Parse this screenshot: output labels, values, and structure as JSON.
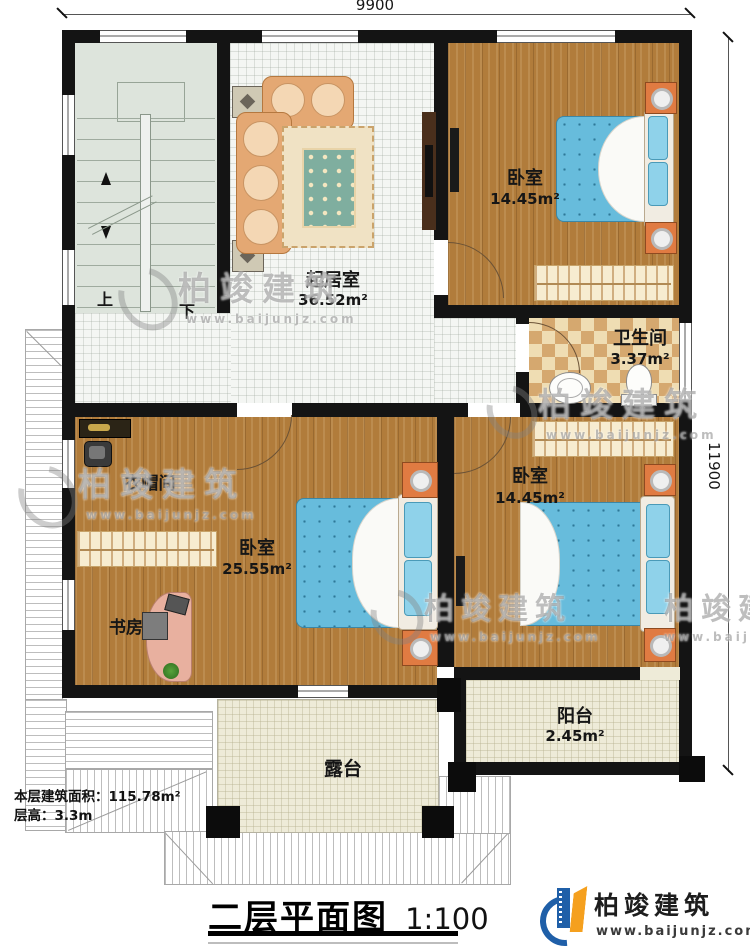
{
  "dimensions": {
    "top": "9900",
    "right": "11900"
  },
  "stairs": {
    "up": "上",
    "down": "下"
  },
  "rooms": {
    "living": {
      "name": "起居室",
      "area": "36.52m²"
    },
    "bedroom_top": {
      "name": "卧室",
      "area": "14.45m²"
    },
    "bathroom": {
      "name": "卫生间",
      "area": "3.37m²"
    },
    "cloakroom": {
      "name": "衣帽间"
    },
    "master_bedroom": {
      "name": "卧室",
      "area": "25.55m²"
    },
    "study": {
      "name": "书房"
    },
    "bedroom_lower": {
      "name": "卧室",
      "area": "14.45m²"
    },
    "balcony": {
      "name": "阳台",
      "area": "2.45m²"
    },
    "terrace": {
      "name": "露台"
    }
  },
  "info": {
    "floor_area": "本层建筑面积：115.78m²",
    "floor_height": "层高：3.3m"
  },
  "title": {
    "text": "二层平面图",
    "scale": "1:100"
  },
  "brand": {
    "name": "柏竣建筑",
    "url": "www.baijunjz.com"
  },
  "watermark": {
    "name": "柏竣建筑",
    "url": "www.baijunjz.com"
  },
  "colors": {
    "wall": "#141414",
    "wood": "#b17c3b",
    "tile": "#f4f6f3",
    "checker_light": "#efddb3",
    "checker_dark": "#d5a86f",
    "bed_blue": "#67bcdc",
    "nightstand_orange": "#e07b42",
    "cream_tile": "#eeebd8",
    "brand_blue": "#1f5fa8",
    "brand_orange": "#f5a01e"
  }
}
